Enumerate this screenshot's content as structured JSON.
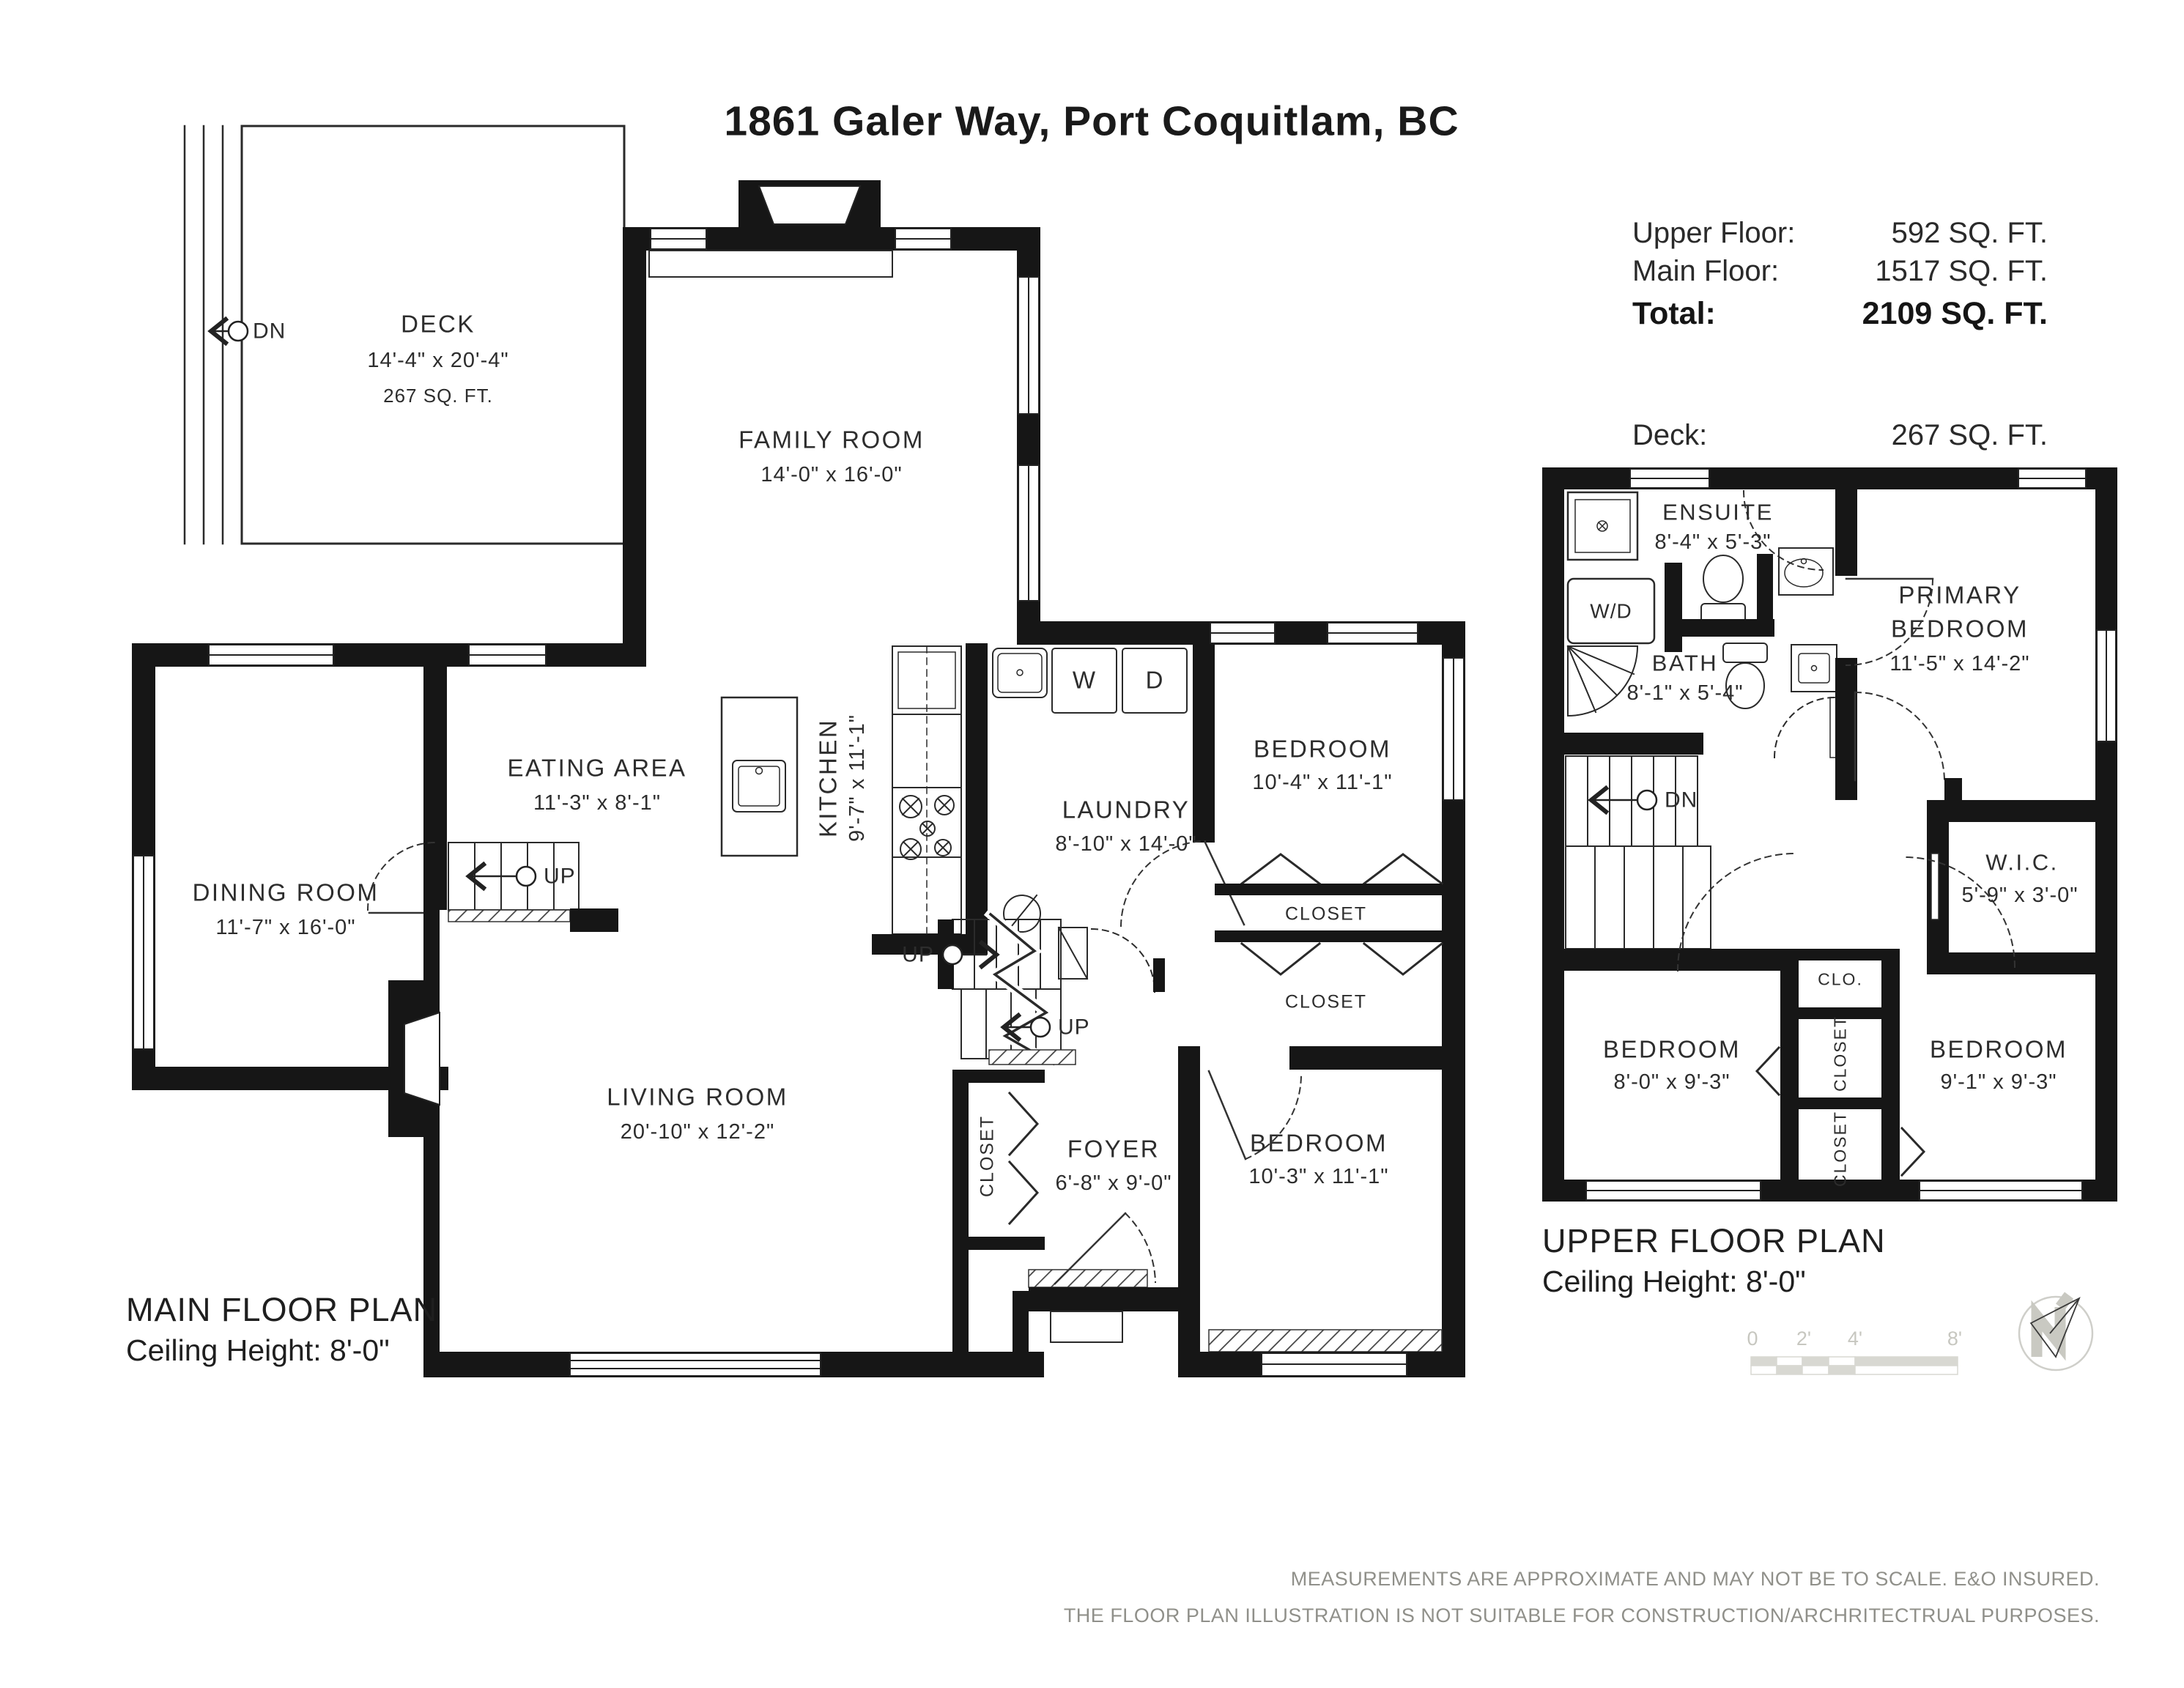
{
  "title": "1861 Galer Way, Port Coquitlam, BC",
  "summary": {
    "rows": [
      {
        "label": "Upper Floor:",
        "value": "592 SQ. FT."
      },
      {
        "label": "Main Floor:",
        "value": "1517 SQ. FT."
      },
      {
        "label": "Total:",
        "value": "2109 SQ. FT."
      },
      {
        "label": "Deck:",
        "value": "267 SQ. FT."
      }
    ]
  },
  "main_floor": {
    "plan_label": "MAIN FLOOR PLAN",
    "ceiling": "Ceiling Height: 8'-0\"",
    "deck": {
      "name": "DECK",
      "dims": "14'-4\" x 20'-4\"",
      "area": "267 SQ. FT."
    },
    "family": {
      "name": "FAMILY ROOM",
      "dims": "14'-0\" x 16'-0\""
    },
    "eating": {
      "name": "EATING AREA",
      "dims": "11'-3\" x 8'-1\""
    },
    "dining": {
      "name": "DINING ROOM",
      "dims": "11'-7\" x 16'-0\""
    },
    "kitchen": {
      "name": "KITCHEN",
      "dims": "9'-7\" x 11'-1\""
    },
    "laundry": {
      "name": "LAUNDRY",
      "dims": "8'-10\" x 14'-0\""
    },
    "bedroom_top": {
      "name": "BEDROOM",
      "dims": "10'-4\" x 11'-1\""
    },
    "bedroom_bottom": {
      "name": "BEDROOM",
      "dims": "10'-3\" x 11'-1\""
    },
    "living": {
      "name": "LIVING ROOM",
      "dims": "20'-10\" x 12'-2\""
    },
    "foyer": {
      "name": "FOYER",
      "dims": "6'-8\" x 9'-0\""
    },
    "closet1": "CLOSET",
    "closet2": "CLOSET",
    "closet_foyer": "CLOSET",
    "washer": "W",
    "dryer": "D",
    "dn": "DN",
    "up_dining": "UP",
    "up_mid": "UP",
    "up_low": "UP"
  },
  "upper_floor": {
    "plan_label": "UPPER FLOOR PLAN",
    "ceiling": "Ceiling Height: 8'-0\"",
    "ensuite": {
      "name": "ENSUITE",
      "dims": "8'-4\" x 5'-3\""
    },
    "bath": {
      "name": "BATH",
      "dims": "8'-1\" x 5'-4\""
    },
    "primary": {
      "line1": "PRIMARY",
      "line2": "BEDROOM",
      "dims": "11'-5\" x 14'-2\""
    },
    "wic": {
      "name": "W.I.C.",
      "dims": "5'-9\" x 3'-0\""
    },
    "bedroom_left": {
      "name": "BEDROOM",
      "dims": "8'-0\" x 9'-3\""
    },
    "bedroom_right": {
      "name": "BEDROOM",
      "dims": "9'-1\" x 9'-3\""
    },
    "wd": "W/D",
    "clo": "CLO.",
    "closet_upper": "CLOSET",
    "closet_lower": "CLOSET",
    "dn": "DN"
  },
  "scale_bar": {
    "labels": [
      "0",
      "2'",
      "4'",
      "8'"
    ]
  },
  "disclaimer": {
    "line1": "MEASUREMENTS ARE APPROXIMATE AND MAY NOT BE TO SCALE.  E&O INSURED.",
    "line2": "THE FLOOR PLAN ILLUSTRATION IS NOT SUITABLE FOR CONSTRUCTION/ARCHRITECTRUAL PURPOSES."
  },
  "colors": {
    "wall": "#161616",
    "text": "#2d2d2d",
    "light_gray": "#d8d8d2",
    "disclaimer_gray": "#90908a"
  }
}
